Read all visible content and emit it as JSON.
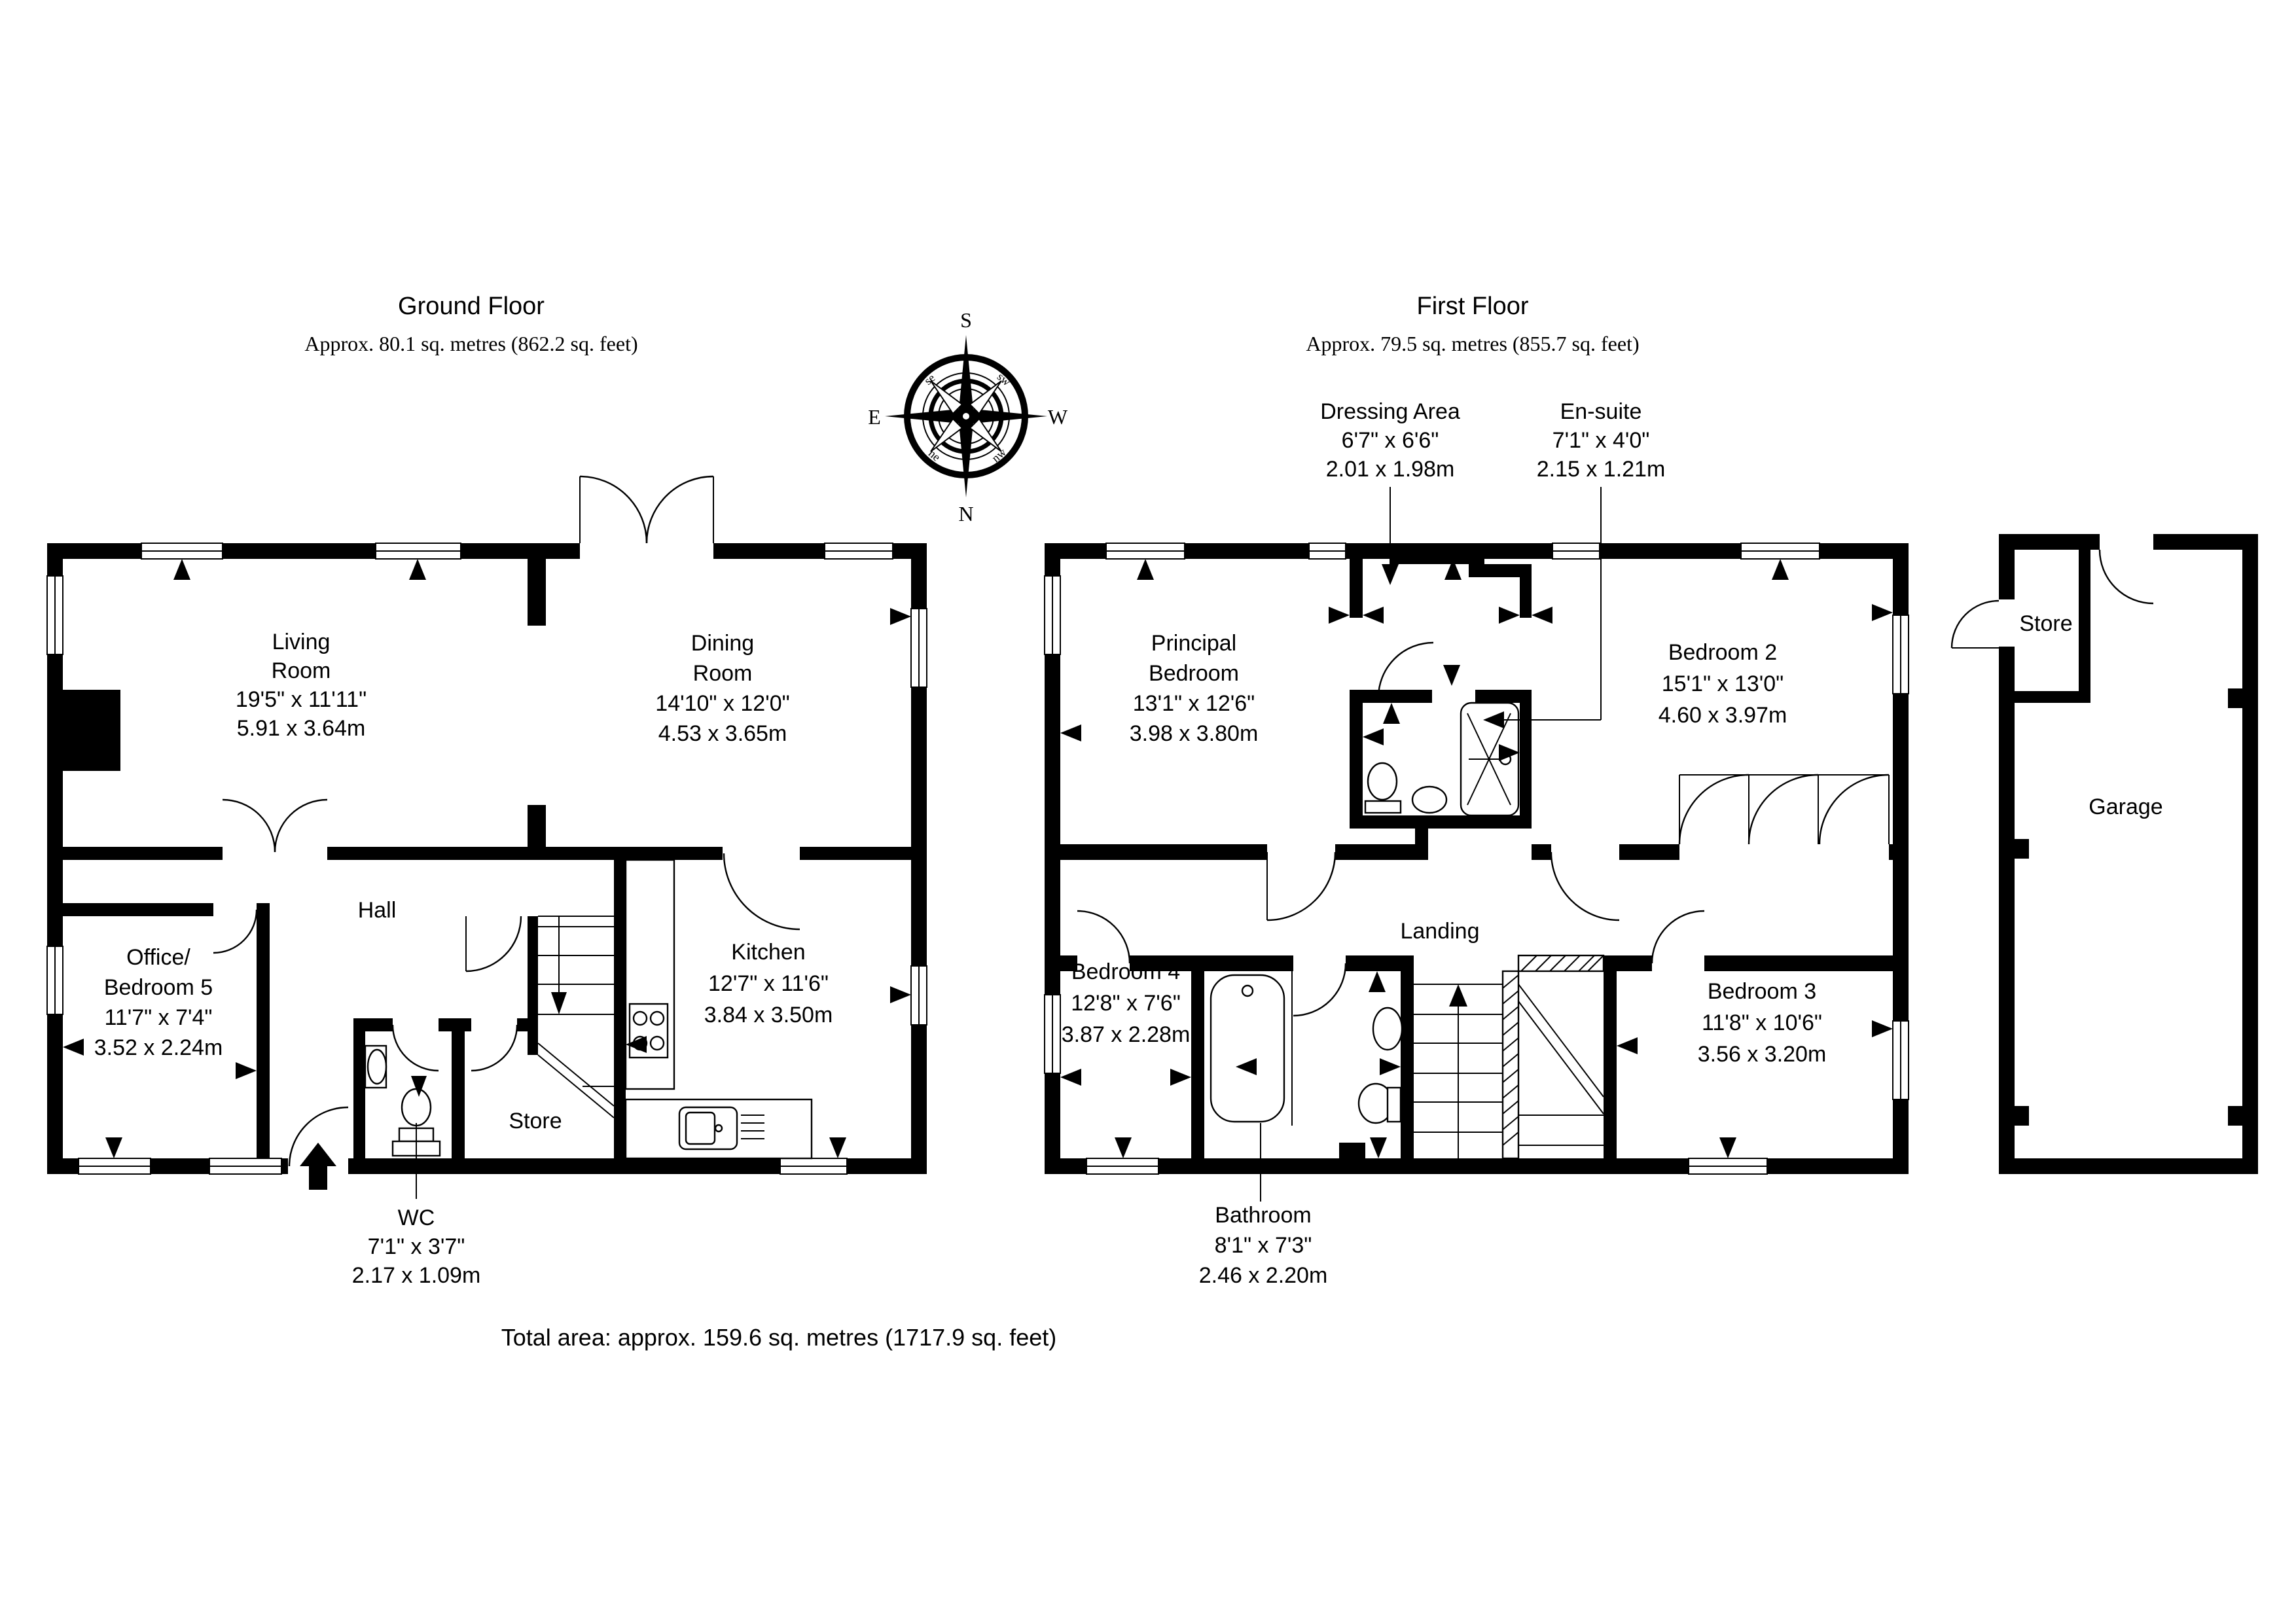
{
  "page": {
    "background": "#ffffff",
    "line_color": "#000000"
  },
  "ground_floor": {
    "title": "Ground Floor",
    "subtitle": "Approx. 80.1 sq. metres (862.2 sq. feet)"
  },
  "first_floor": {
    "title": "First Floor",
    "subtitle": "Approx. 79.5 sq. metres (855.7 sq. feet)"
  },
  "total_area": "Total area: approx. 159.6 sq. metres (1717.9 sq. feet)",
  "compass": {
    "north": "N",
    "south": "S",
    "east": "E",
    "west": "W",
    "ne": "ne",
    "nw": "nw",
    "se": "se",
    "sw": "sw"
  },
  "rooms": {
    "living": {
      "lines": [
        "Living",
        "Room",
        "19'5\" x 11'11\"",
        "5.91 x 3.64m"
      ]
    },
    "dining": {
      "lines": [
        "Dining",
        "Room",
        "14'10\" x 12'0\"",
        "4.53 x 3.65m"
      ]
    },
    "kitchen": {
      "lines": [
        "Kitchen",
        "12'7\" x 11'6\"",
        "3.84 x 3.50m"
      ]
    },
    "hall": {
      "lines": [
        "Hall"
      ]
    },
    "office_bedroom5": {
      "lines": [
        "Office/",
        "Bedroom 5",
        "11'7\" x 7'4\"",
        "3.52 x 2.24m"
      ]
    },
    "store_ground": {
      "lines": [
        "Store"
      ]
    },
    "wc": {
      "lines": [
        "WC",
        "7'1\" x 3'7\"",
        "2.17 x 1.09m"
      ]
    },
    "principal_bedroom": {
      "lines": [
        "Principal",
        "Bedroom",
        "13'1\" x 12'6\"",
        "3.98 x 3.80m"
      ]
    },
    "dressing_area": {
      "lines": [
        "Dressing Area",
        "6'7\" x 6'6\"",
        "2.01 x 1.98m"
      ]
    },
    "ensuite": {
      "lines": [
        "En-suite",
        "7'1\" x 4'0\"",
        "2.15 x 1.21m"
      ]
    },
    "bedroom2": {
      "lines": [
        "Bedroom 2",
        "15'1\" x 13'0\"",
        "4.60 x 3.97m"
      ]
    },
    "bedroom4": {
      "lines": [
        "Bedroom 4",
        "12'8\" x 7'6\"",
        "3.87 x 2.28m"
      ]
    },
    "landing": {
      "lines": [
        "Landing"
      ]
    },
    "bedroom3": {
      "lines": [
        "Bedroom 3",
        "11'8\" x 10'6\"",
        "3.56 x 3.20m"
      ]
    },
    "bathroom": {
      "lines": [
        "Bathroom",
        "8'1\" x 7'3\"",
        "2.46 x 2.20m"
      ]
    },
    "store_garage": {
      "lines": [
        "Store"
      ]
    },
    "garage": {
      "lines": [
        "Garage"
      ]
    }
  }
}
